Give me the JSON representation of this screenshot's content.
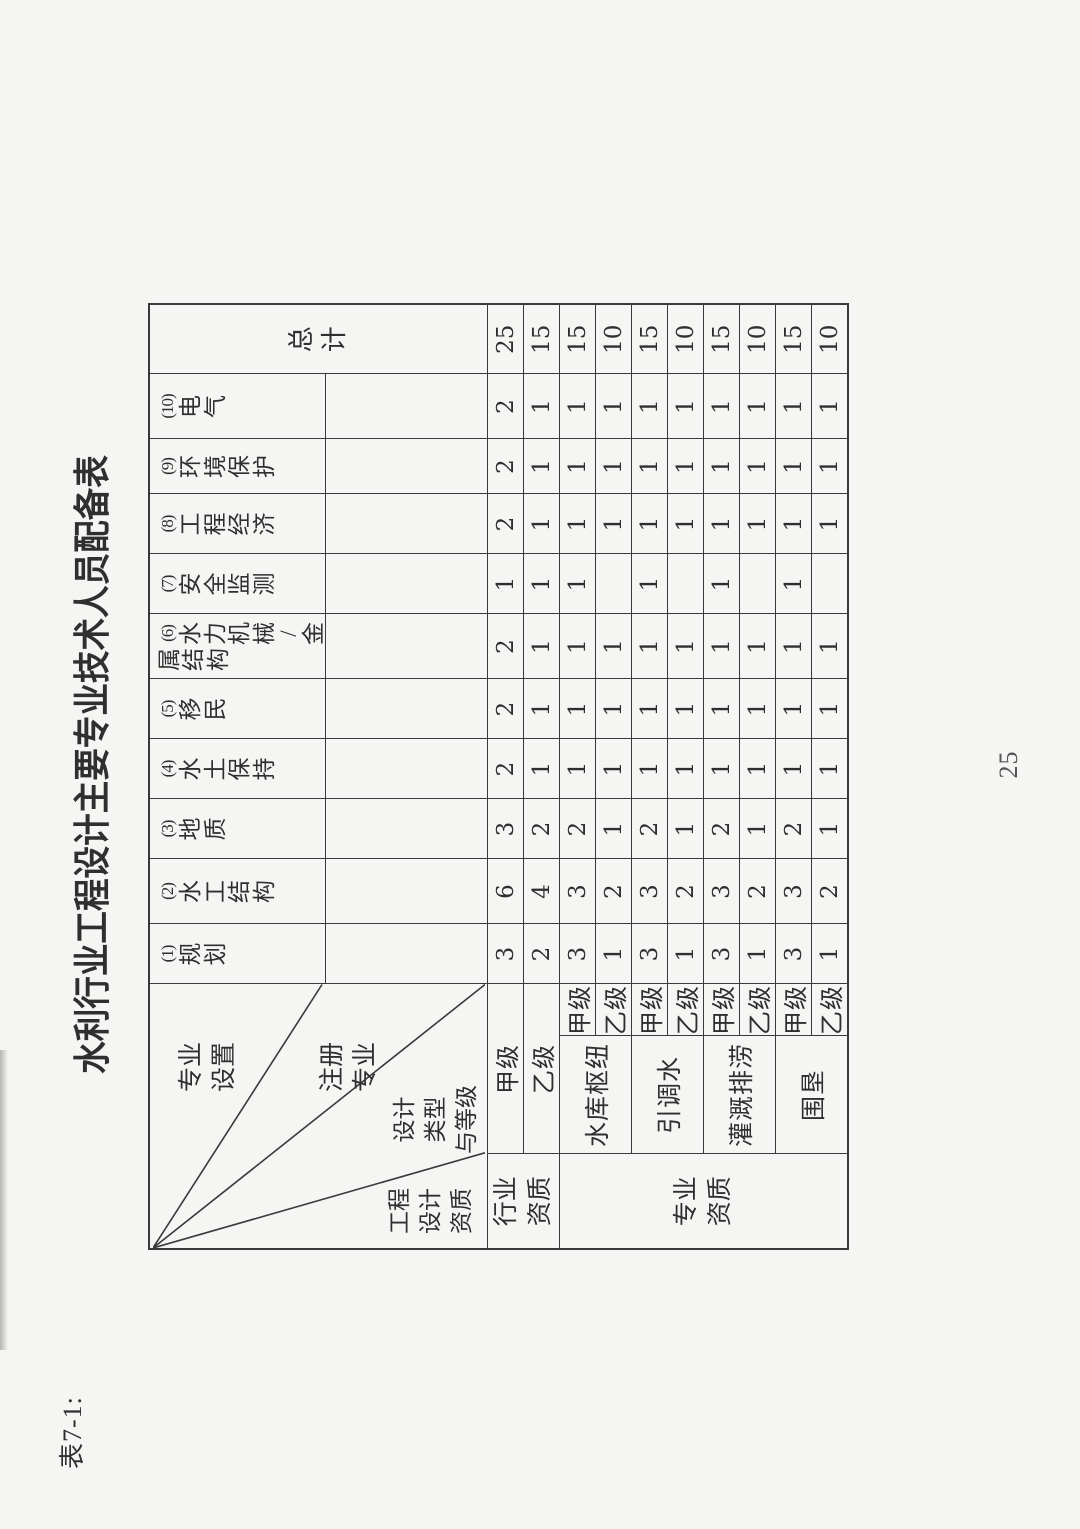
{
  "page": {
    "ref_label": "表7-1:",
    "title": "水利行业工程设计主要专业技术人员配备表",
    "page_number": "25"
  },
  "colors": {
    "paper": "#f5f5f3",
    "ink": "#2f2f2f",
    "line": "#3a3a3a"
  },
  "corner": {
    "specialty_setup": {
      "text": "专业设置",
      "lines": [
        "专业",
        "设置"
      ]
    },
    "registered_specialty": {
      "text": "注册专业",
      "lines": [
        "注册",
        "专业"
      ]
    },
    "design_type_grade": {
      "text": "设计类型与等级",
      "lines": [
        "设计",
        "类型",
        "与等级"
      ]
    },
    "design_qualification": {
      "text": "工程设计资质",
      "lines": [
        "工程",
        "设计",
        "资质"
      ]
    }
  },
  "chart_data": {
    "type": "table",
    "title": "水利行业工程设计主要专业技术人员配备表",
    "column_headers": [
      {
        "label": "(1)规划",
        "vcols": [
          "(1)规划"
        ]
      },
      {
        "label": "(2)水工结构",
        "vcols": [
          "(2)水工结构"
        ]
      },
      {
        "label": "(3)地质",
        "vcols": [
          "(3)地质"
        ]
      },
      {
        "label": "(4)水土保持",
        "vcols": [
          "(4)水土保持"
        ]
      },
      {
        "label": "(5)移民",
        "vcols": [
          "(5)移民"
        ]
      },
      {
        "label": "(6)水力机械/金属结构",
        "vcols": [
          "(6)水力机械/金",
          "属结构"
        ]
      },
      {
        "label": "(7)安全监测",
        "vcols": [
          "(7)安全监测"
        ]
      },
      {
        "label": "(8)工程经济",
        "vcols": [
          "(8)工程经济"
        ]
      },
      {
        "label": "(9)环境保护",
        "vcols": [
          "(9)环境保护"
        ]
      },
      {
        "label": "(10)电气",
        "vcols": [
          "(10)电气"
        ]
      }
    ],
    "total_header": "总计",
    "groups": [
      {
        "label": "行业资质",
        "lines": [
          "行业",
          "资质"
        ],
        "rows": [
          {
            "grade": "甲级",
            "values": [
              "3",
              "6",
              "3",
              "2",
              "2",
              "2",
              "1",
              "2",
              "2",
              "2"
            ],
            "total": "25"
          },
          {
            "grade": "乙级",
            "values": [
              "2",
              "4",
              "2",
              "1",
              "1",
              "1",
              "1",
              "1",
              "1",
              "1"
            ],
            "total": "15"
          }
        ]
      },
      {
        "label": "专业资质",
        "lines": [
          "专业",
          "资质"
        ],
        "subgroups": [
          {
            "label": "水库枢纽",
            "rows": [
              {
                "grade": "甲级",
                "values": [
                  "3",
                  "3",
                  "2",
                  "1",
                  "1",
                  "1",
                  "1",
                  "1",
                  "1",
                  "1"
                ],
                "total": "15"
              },
              {
                "grade": "乙级",
                "values": [
                  "1",
                  "2",
                  "1",
                  "1",
                  "1",
                  "1",
                  "",
                  "1",
                  "1",
                  "1"
                ],
                "total": "10"
              }
            ]
          },
          {
            "label": "引调水",
            "rows": [
              {
                "grade": "甲级",
                "values": [
                  "3",
                  "3",
                  "2",
                  "1",
                  "1",
                  "1",
                  "1",
                  "1",
                  "1",
                  "1"
                ],
                "total": "15"
              },
              {
                "grade": "乙级",
                "values": [
                  "1",
                  "2",
                  "1",
                  "1",
                  "1",
                  "1",
                  "",
                  "1",
                  "1",
                  "1"
                ],
                "total": "10"
              }
            ]
          },
          {
            "label": "灌溉排涝",
            "rows": [
              {
                "grade": "甲级",
                "values": [
                  "3",
                  "3",
                  "2",
                  "1",
                  "1",
                  "1",
                  "1",
                  "1",
                  "1",
                  "1"
                ],
                "total": "15"
              },
              {
                "grade": "乙级",
                "values": [
                  "1",
                  "2",
                  "1",
                  "1",
                  "1",
                  "1",
                  "",
                  "1",
                  "1",
                  "1"
                ],
                "total": "10"
              }
            ]
          },
          {
            "label": "围垦",
            "rows": [
              {
                "grade": "甲级",
                "values": [
                  "3",
                  "3",
                  "2",
                  "1",
                  "1",
                  "1",
                  "1",
                  "1",
                  "1",
                  "1"
                ],
                "total": "15"
              },
              {
                "grade": "乙级",
                "values": [
                  "1",
                  "2",
                  "1",
                  "1",
                  "1",
                  "1",
                  "",
                  "1",
                  "1",
                  "1"
                ],
                "total": "10"
              }
            ]
          }
        ]
      }
    ]
  }
}
